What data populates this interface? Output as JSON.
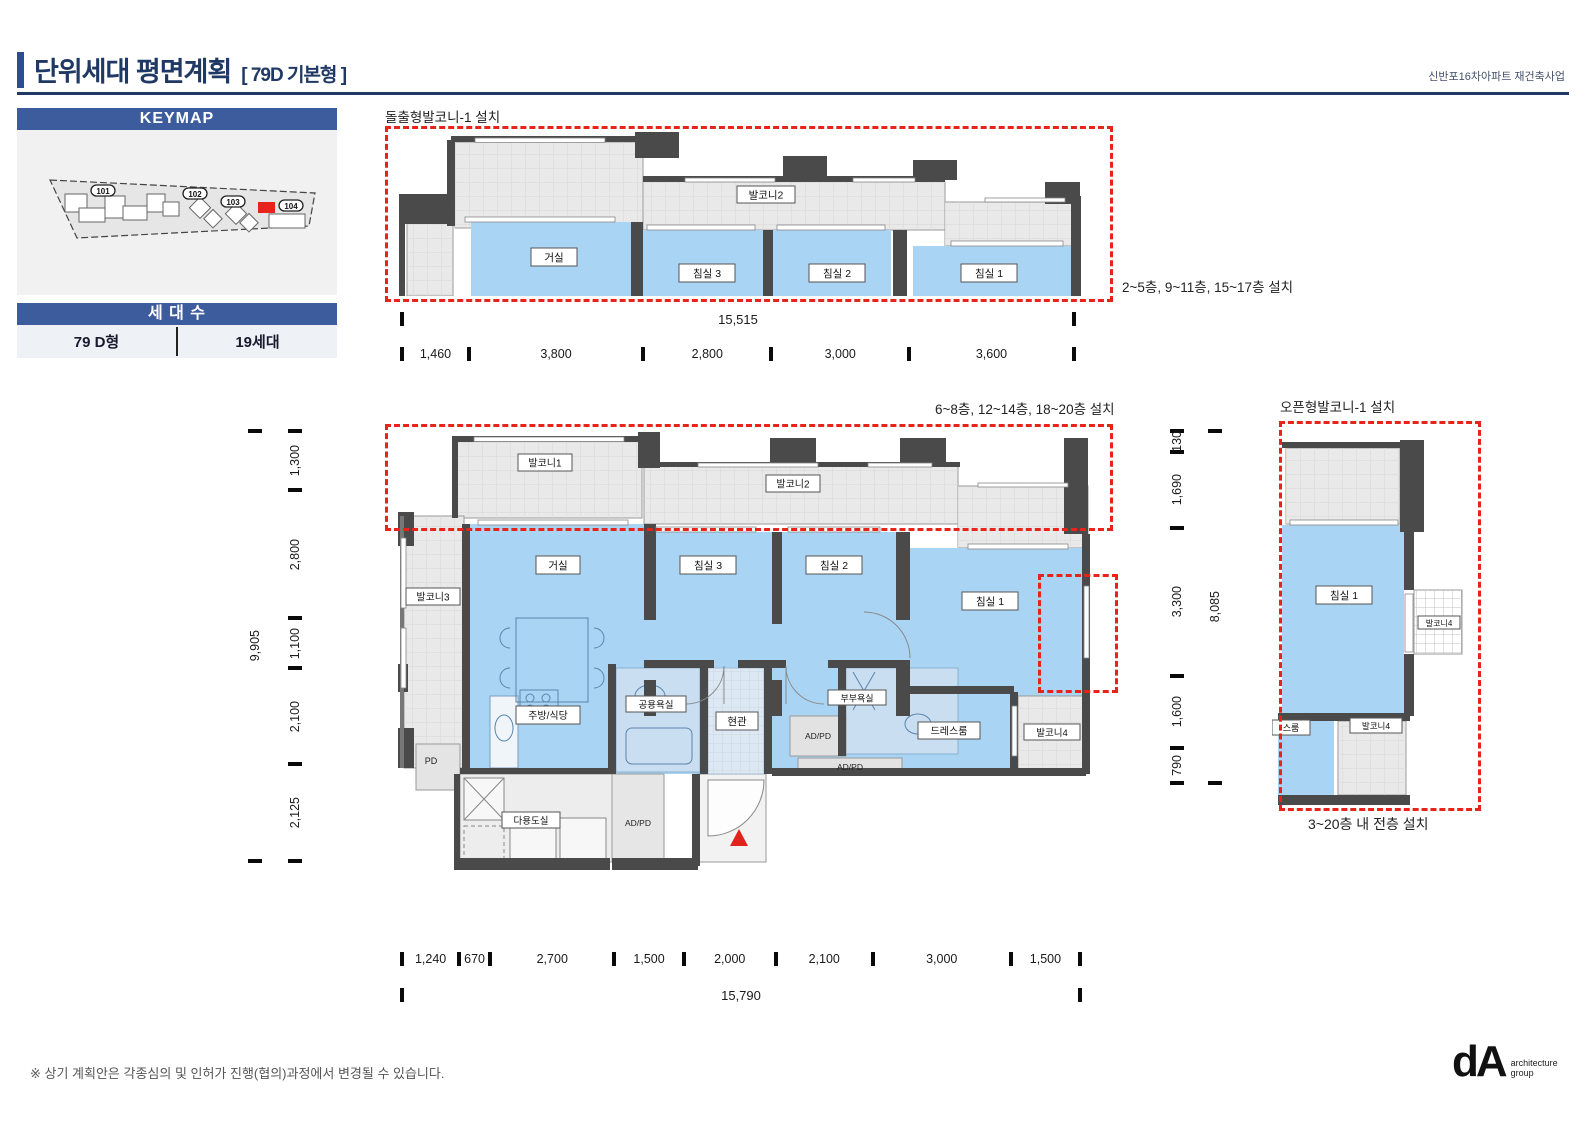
{
  "header": {
    "title": "단위세대 평면계획",
    "subtitle": "[ 79D 기본형 ]",
    "project": "신반포16차아파트 재건축사업"
  },
  "keymap": {
    "title": "KEYMAP",
    "buildings": [
      "101",
      "102",
      "103",
      "104"
    ]
  },
  "units": {
    "title": "세 대 수",
    "type": "79 D형",
    "count": "19세대"
  },
  "plans": {
    "top": {
      "label": "돌출형발코니-1 설치",
      "note": "2~5층, 9~11층, 15~17층 설치",
      "rooms": {
        "balcony2": "발코니2",
        "living": "거실",
        "bed3": "침실 3",
        "bed2": "침실 2",
        "bed1": "침실 1"
      }
    },
    "main": {
      "note": "6~8층, 12~14층, 18~20층 설치",
      "rooms": {
        "balcony1": "발코니1",
        "balcony2": "발코니2",
        "balcony3": "발코니3",
        "living": "거실",
        "bed3": "침실 3",
        "bed2": "침실 2",
        "bed1": "침실 1",
        "kitchen": "주방/식당",
        "bath_common": "공용욕실",
        "entrance": "현관",
        "bath_master": "부부욕실",
        "dress": "드레스룸",
        "balcony4": "발코니4",
        "pd": "PD",
        "utility": "다용도실",
        "adpd": "AD/PD"
      }
    },
    "open": {
      "label": "오픈형발코니-1 설치",
      "note": "3~20층 내 전층 설치",
      "rooms": {
        "bed1": "침실 1",
        "balcony4": "발코니4",
        "dress_partial": "스룸"
      }
    }
  },
  "dims": {
    "top_total": "15,515",
    "top": [
      "1,460",
      "3,800",
      "2,800",
      "3,000",
      "3,600"
    ],
    "bottom": [
      "1,240",
      "670",
      "2,700",
      "1,500",
      "2,000",
      "2,100",
      "3,000",
      "1,500"
    ],
    "bottom_total": "15,790",
    "left": [
      "1,300",
      "2,800",
      "1,100",
      "2,100",
      "2,125"
    ],
    "left_total": "9,905",
    "right": [
      "130",
      "1,690",
      "3,300",
      "1,600",
      "790"
    ],
    "right_total": "8,085"
  },
  "footer": {
    "note": "※ 상기 계획안은 각종심의 및 인허가 진행(협의)과정에서 변경될 수 있습니다.",
    "logo": "dA",
    "logo_line1": "architecture",
    "logo_line2": "group"
  },
  "colors": {
    "header_blue": "#3d5c9e",
    "title_navy": "#1f3864",
    "room_blue": "#aad4f3",
    "balcony_gray": "#e9e9e9",
    "wall_dark": "#4a4a4a",
    "highlight_red": "#e8231a"
  }
}
